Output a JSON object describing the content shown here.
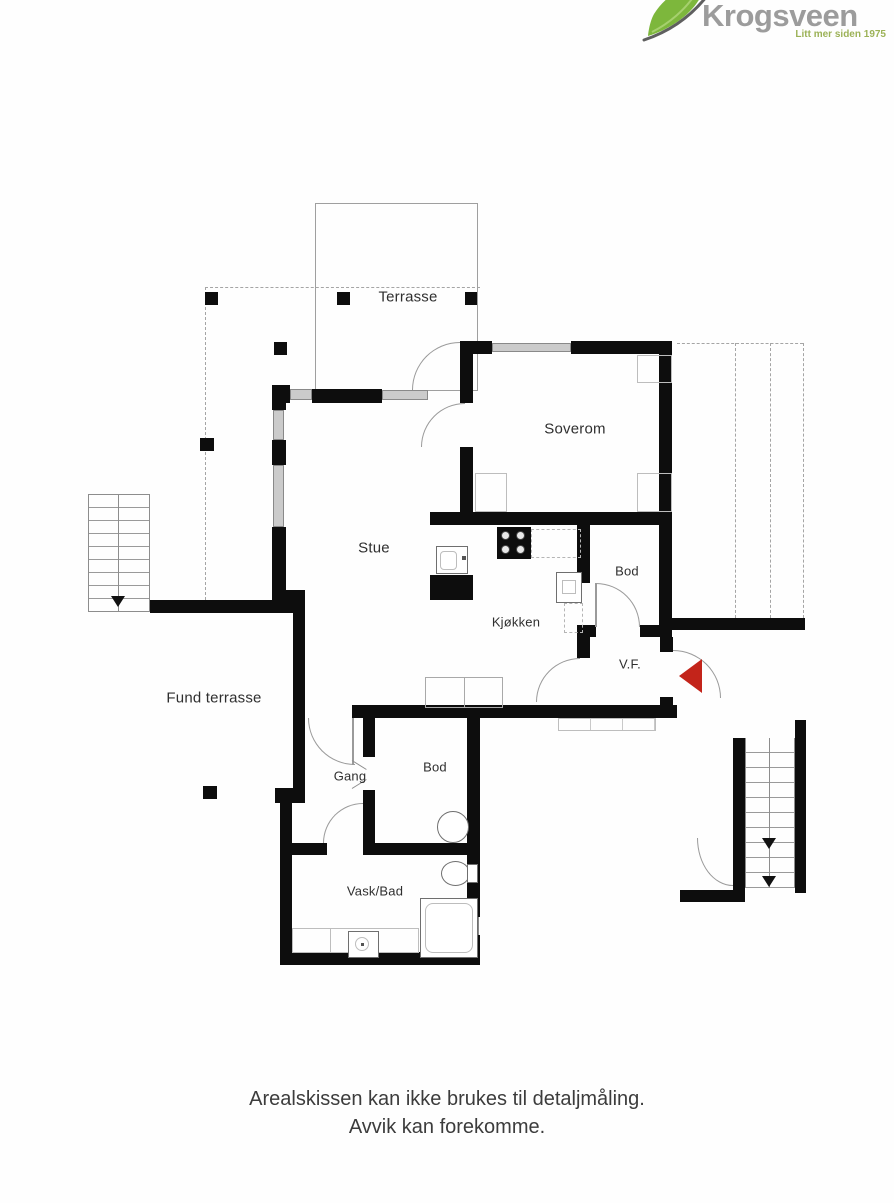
{
  "logo": {
    "brand": "Krogsveen",
    "tagline": "Litt mer siden 1975"
  },
  "colors": {
    "wall": "#0d0d0d",
    "window_fill": "#cbcbcb",
    "label": "#2f2f2f",
    "brand_text": "#9c9c9c",
    "leaf_green": "#7db73c",
    "tagline_green": "#9cb257",
    "entrance_red": "#c3241a"
  },
  "rooms": {
    "terrasse": "Terrasse",
    "soverom": "Soverom",
    "stue": "Stue",
    "kjokken": "Kjøkken",
    "bod_upper": "Bod",
    "vf": "V.F.",
    "fund_terrasse": "Fund terrasse",
    "gang": "Gang",
    "bod_lower": "Bod",
    "vask_bad": "Vask/Bad"
  },
  "footer": {
    "line1": "Arealskissen kan ikke brukes til detaljmåling.",
    "line2": "Avvik kan forekomme."
  }
}
